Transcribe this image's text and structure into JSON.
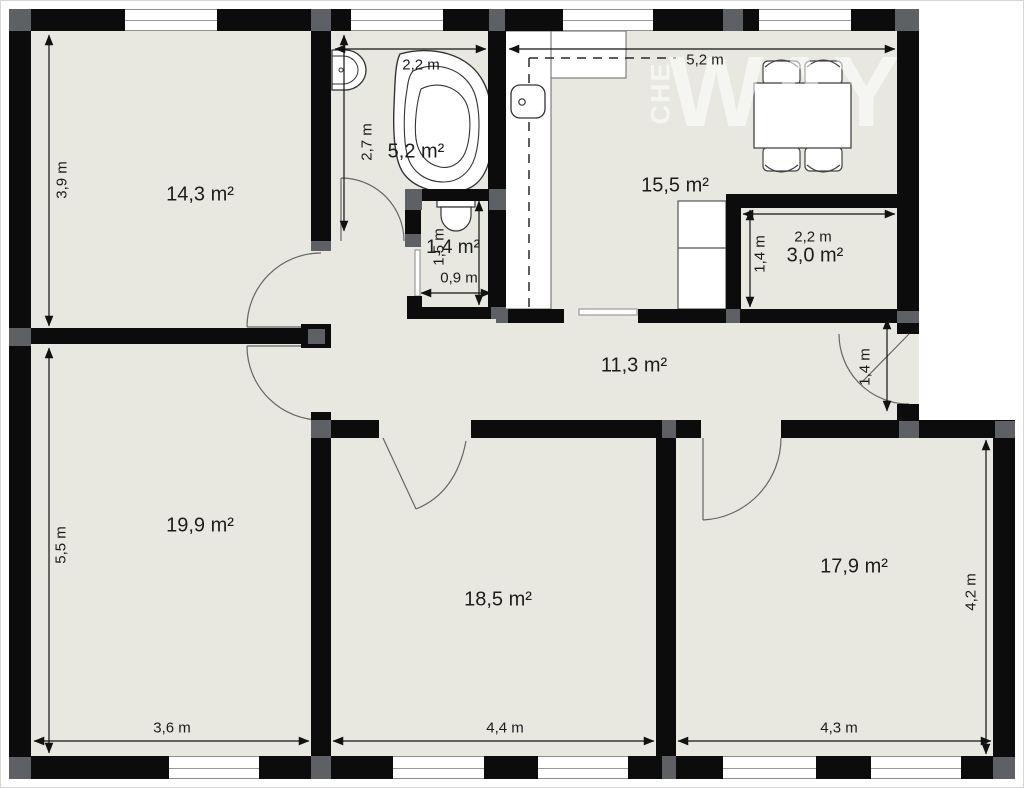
{
  "plan_title": "apartment-floor-plan",
  "rooms": {
    "room_a_area": "14,3 m²",
    "bathroom_area": "5,2 m²",
    "wc_area": "1,4 m²",
    "kitchen_area": "15,5 m²",
    "storage_area": "3,0 m²",
    "hallway_area": "11,3 m²",
    "room_b_area": "19,9 m²",
    "room_c_area": "18,5 m²",
    "room_d_area": "17,9 m²"
  },
  "dimensions": {
    "room_a_height": "3,9 m",
    "bathroom_width": "2,2 m",
    "bathroom_height": "2,7 m",
    "kitchen_width": "5,2 m",
    "wc_width": "0,9 m",
    "wc_height": "1,5 m",
    "storage_width": "2,2 m",
    "storage_height": "1,4 m",
    "balcony_door_width": "1,4 m",
    "room_b_height": "5,5 m",
    "room_b_width": "3,6 m",
    "room_c_width": "4,4 m",
    "room_d_width": "4,3 m",
    "room_d_height": "4,2 m"
  },
  "watermark": {
    "main": "WAY",
    "vertical": "CHE"
  },
  "fixtures": [
    "bathtub",
    "washbasin",
    "toilet",
    "kitchen-counter",
    "kitchen-sink",
    "refrigerator",
    "dining-table",
    "dining-chair",
    "sliding-door",
    "hinged-door"
  ],
  "colors": {
    "floor": "#e8e8e1",
    "wall": "#0c0c0c",
    "junction_pillar": "#5d6166",
    "window": "#ffffff"
  }
}
